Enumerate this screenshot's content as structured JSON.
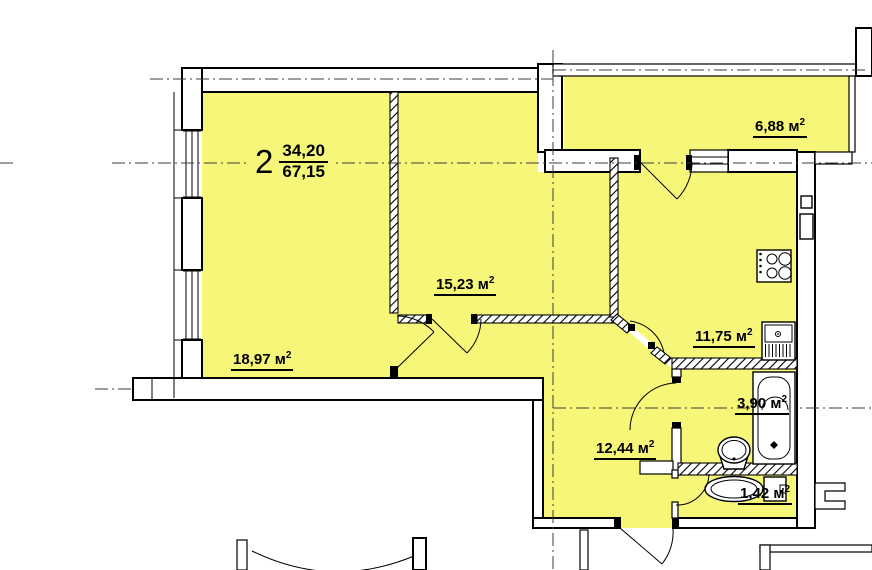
{
  "apartment": {
    "number_label": "2",
    "living_area": "34,20",
    "total_area": "67,15"
  },
  "rooms": [
    {
      "id": "living-room",
      "label": "18,97 м",
      "sup": "2"
    },
    {
      "id": "bedroom",
      "label": "15,23 м",
      "sup": "2"
    },
    {
      "id": "balcony",
      "label": "6,88 м",
      "sup": "2"
    },
    {
      "id": "kitchen",
      "label": "11,75 м",
      "sup": "2"
    },
    {
      "id": "bathroom",
      "label": "3,90 м",
      "sup": "2"
    },
    {
      "id": "hallway",
      "label": "12,44 м",
      "sup": "2"
    },
    {
      "id": "wc",
      "label": "1,42 м",
      "sup": "2"
    }
  ],
  "colors": {
    "room_fill": "#F6F678",
    "line_color": "#000000",
    "centerline_color": "#3C3C3C",
    "page_bg": "#FFFFFF"
  }
}
